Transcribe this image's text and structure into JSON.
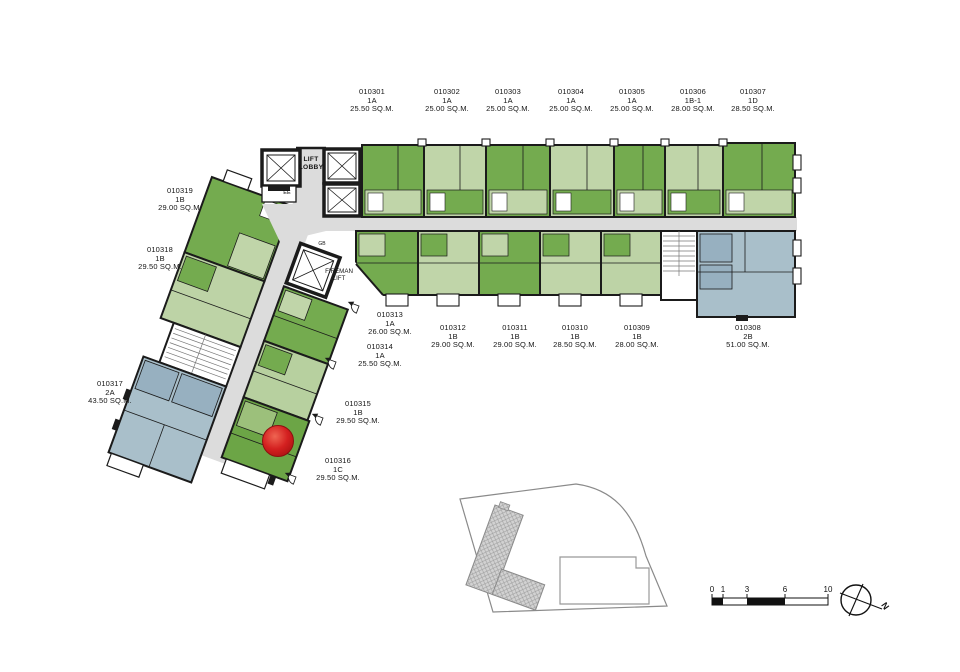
{
  "units": [
    {
      "id": "010301",
      "type": "1A",
      "area": "25.50 SQ.M."
    },
    {
      "id": "010302",
      "type": "1A",
      "area": "25.00 SQ.M."
    },
    {
      "id": "010303",
      "type": "1A",
      "area": "25.00 SQ.M."
    },
    {
      "id": "010304",
      "type": "1A",
      "area": "25.00 SQ.M."
    },
    {
      "id": "010305",
      "type": "1A",
      "area": "25.00 SQ.M."
    },
    {
      "id": "010306",
      "type": "1B-1",
      "area": "28.00 SQ.M."
    },
    {
      "id": "010307",
      "type": "1D",
      "area": "28.50 SQ.M."
    },
    {
      "id": "010308",
      "type": "2B",
      "area": "51.00 SQ.M."
    },
    {
      "id": "010309",
      "type": "1B",
      "area": "28.00 SQ.M."
    },
    {
      "id": "010310",
      "type": "1B",
      "area": "28.50 SQ.M."
    },
    {
      "id": "010311",
      "type": "1B",
      "area": "29.00 SQ.M."
    },
    {
      "id": "010312",
      "type": "1B",
      "area": "29.00 SQ.M."
    },
    {
      "id": "010313",
      "type": "1A",
      "area": "26.00 SQ.M."
    },
    {
      "id": "010314",
      "type": "1A",
      "area": "25.50 SQ.M."
    },
    {
      "id": "010315",
      "type": "1B",
      "area": "29.50 SQ.M."
    },
    {
      "id": "010316",
      "type": "1C",
      "area": "29.50 SQ.M."
    },
    {
      "id": "010317",
      "type": "2A",
      "area": "43.50 SQ.M."
    },
    {
      "id": "010318",
      "type": "1B",
      "area": "29.50 SQ.M."
    },
    {
      "id": "010319",
      "type": "1B",
      "area": "29.00 SQ.M."
    }
  ],
  "plan_labels": {
    "lift_lobby": "LIFT LOBBY",
    "fireman_lift": "FIREMAN LIFT",
    "ee": "EE",
    "gb": "GB"
  },
  "marker": {
    "unit": "010316",
    "color": "#d42020"
  },
  "scale_bar": {
    "ticks": [
      "0",
      "1",
      "3",
      "6",
      "10"
    ]
  },
  "compass": {
    "label": "N"
  },
  "colors": {
    "unit_green_medium": "#74ab4f",
    "unit_green_light": "#c0d5a9",
    "unit_blue": "#a9bfca",
    "corridor_gray": "#dcdcdc",
    "wall": "#1b1b1b",
    "marker_red": "#d42020"
  }
}
